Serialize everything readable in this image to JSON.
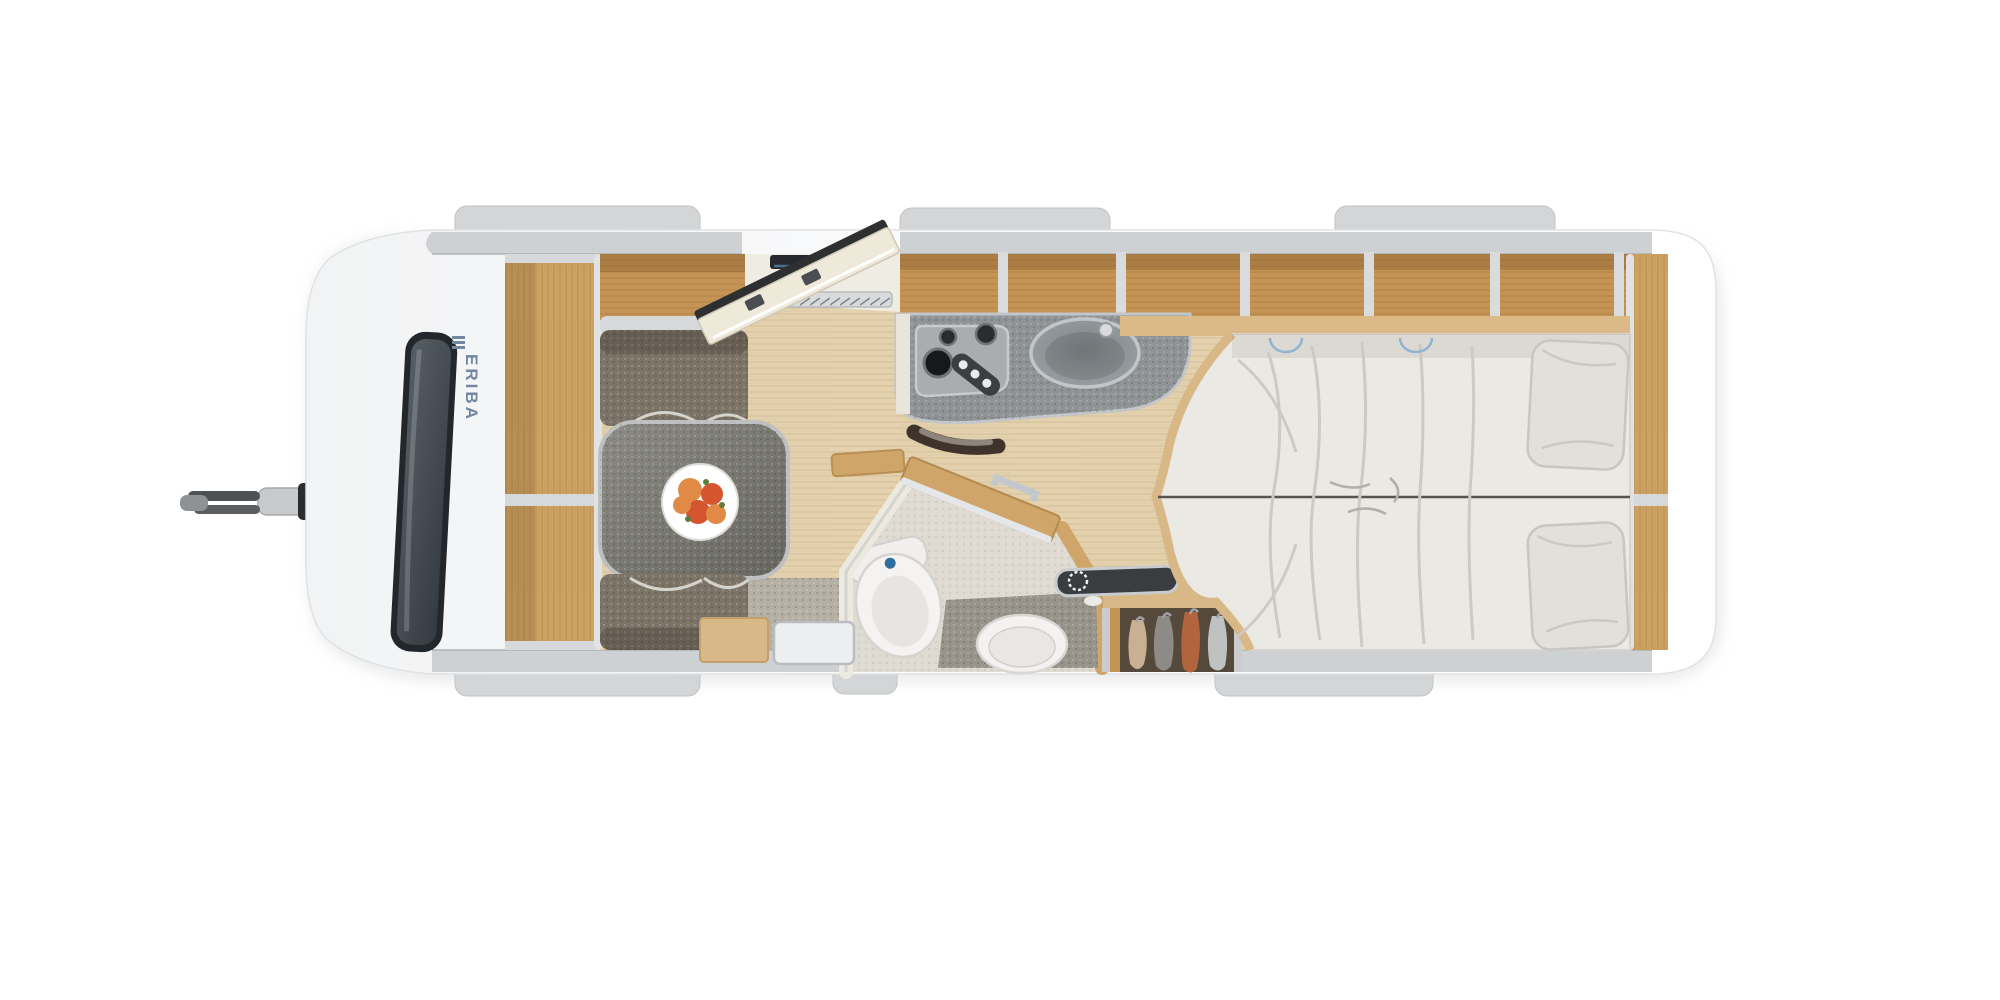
{
  "page": {
    "background": "#ffffff",
    "description": "Top-view floor plan rendering of an ERIBA travel trailer caravan"
  },
  "brand": {
    "logo_text": "ERIBA",
    "logo_color": "#7388a0"
  },
  "palette": {
    "hull": "#fcfcfd",
    "wall": "#ced1d4",
    "trim": "#d6d8da",
    "tab": "#d3d5d7",
    "wood": "#cda263",
    "wood_dark": "#c2914f",
    "floor": "#e4d2ae",
    "upholstery": "#7d7468",
    "table": "#7e7d78",
    "counter": "#8f9396",
    "bedding": "#ebe9e4",
    "pillow": "#e2e0db",
    "carpet": "#b5afa4",
    "window": "#41474f",
    "accent_red": "#d0342c",
    "flush_blue": "#2e6f9e",
    "hob": "#a9adb0",
    "bath_wall": "#ece9df",
    "door_panel": "#efe9da"
  },
  "clothes": {
    "beige": "#c8b093",
    "gray": "#8e8b86",
    "rust": "#b2653d",
    "light": "#c0c2c1"
  },
  "fruit": {
    "plate": "#ffffff",
    "peach": "#e08a45",
    "red": "#d5552f",
    "leaf": "#5f7d3a"
  },
  "features": [
    "tow-hitch",
    "jockey-handle",
    "front-window",
    "eriba-logo",
    "front-shelf-unit",
    "overhead-lockers",
    "dinette-bench-upper",
    "dinette-bench-lower",
    "dinette-table",
    "fruit-plate",
    "entry-door-open",
    "entry-threshold",
    "kitchen-counter",
    "gas-hob",
    "hob-knobs",
    "kitchen-sink",
    "faucet",
    "bathroom",
    "toilet",
    "washbasin",
    "bathroom-door",
    "shower-mat",
    "wardrobe",
    "hanging-clothes",
    "radio-panel",
    "rear-shelf-unit",
    "twin-bed",
    "bed-seam",
    "pillow-top",
    "pillow-bottom",
    "roof-tabs"
  ]
}
